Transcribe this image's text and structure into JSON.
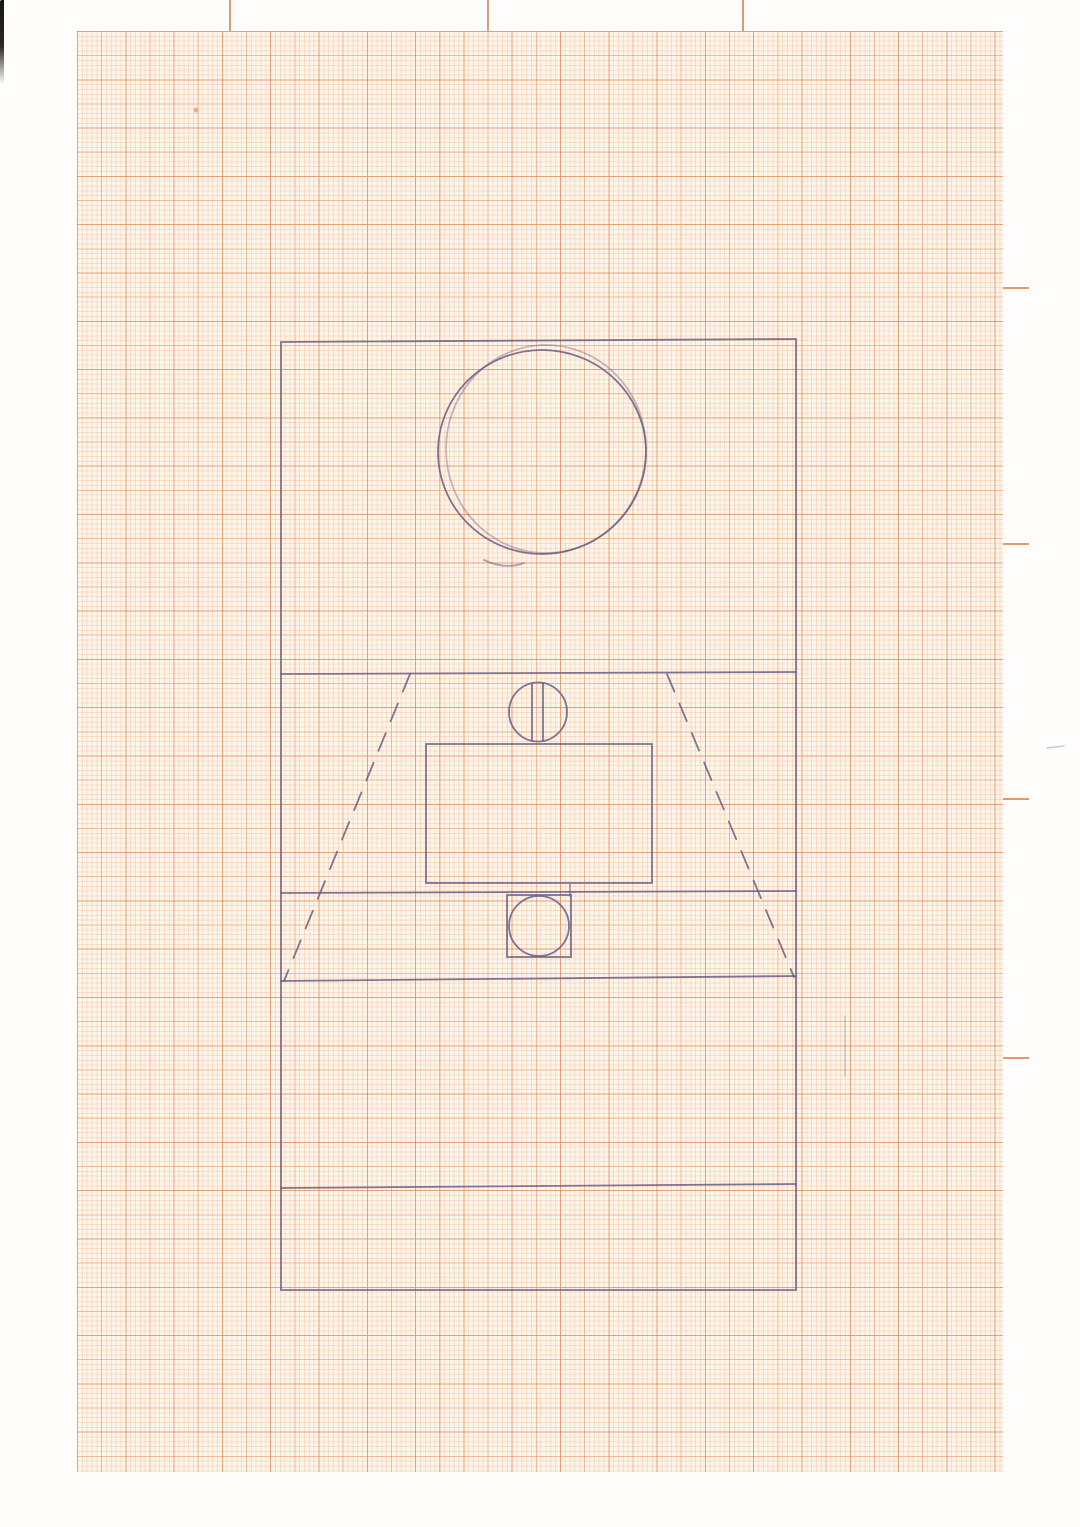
{
  "document": {
    "kind": "scanned hand-drawn sketch on millimeter graph paper",
    "canvas": {
      "width": 1080,
      "height": 1527
    }
  },
  "colors": {
    "paper_bg": "#fdf5e9",
    "grid_minor": "rgba(235,170,125,0.30)",
    "grid_major": "rgba(224,140,92,0.42)",
    "grid_coarse": "rgba(213,123,76,0.40)",
    "tick_color": "#dd9c6f",
    "ink": "#6b5d82",
    "pencil": "#b9c2cc",
    "scan_background": "#fefdfb"
  },
  "paper": {
    "grid_area": {
      "left": 77,
      "top": 31,
      "width": 926,
      "height": 1441
    },
    "minor_spacing_px": 4.83,
    "major_spacing_px": 24.15,
    "top_registration_ticks_x": [
      229,
      487,
      742
    ],
    "right_registration_ticks_y": [
      287,
      543,
      798,
      1057
    ],
    "right_tick_start_x": 1003,
    "right_tick_length": 26
  },
  "sketch": {
    "ink_default": {
      "color": "#6b5d82",
      "width": 1.8,
      "opacity": 0.85
    },
    "shapes": [
      {
        "name": "outer-rectangle",
        "kind": "polygon",
        "points": "281,342 796,339 796,1290 281,1290"
      },
      {
        "name": "large-circle",
        "kind": "ellipse",
        "cx": 542,
        "cy": 452,
        "rx": 104,
        "ry": 102
      },
      {
        "name": "large-circle-overstroke",
        "kind": "ellipse",
        "cx": 546,
        "cy": 449,
        "rx": 100,
        "ry": 104,
        "opacity": 0.4
      },
      {
        "name": "large-circle-tail",
        "kind": "path",
        "d": "M484,560 Q505,570 524,563",
        "opacity": 0.55
      },
      {
        "name": "horizontal-divider-1",
        "kind": "line",
        "x1": 281,
        "y1": 674,
        "x2": 796,
        "y2": 672
      },
      {
        "name": "slotted-circle",
        "kind": "ellipse",
        "cx": 538,
        "cy": 712,
        "rx": 29,
        "ry": 29.5
      },
      {
        "name": "slot-line-left",
        "kind": "line",
        "x1": 532,
        "y1": 684,
        "x2": 532,
        "y2": 740
      },
      {
        "name": "slot-line-right",
        "kind": "line",
        "x1": 543,
        "y1": 683.5,
        "x2": 543,
        "y2": 740.5
      },
      {
        "name": "inner-rectangle",
        "kind": "rect",
        "x": 426,
        "y": 744,
        "w": 226,
        "h": 139
      },
      {
        "name": "horizontal-divider-2",
        "kind": "line",
        "x1": 281,
        "y1": 893,
        "x2": 796,
        "y2": 891
      },
      {
        "name": "small-square",
        "kind": "rect",
        "x": 507,
        "y": 895,
        "w": 64,
        "h": 62
      },
      {
        "name": "small-square-overshoot",
        "kind": "line",
        "x1": 570,
        "y1": 884,
        "x2": 570,
        "y2": 896,
        "opacity": 0.6
      },
      {
        "name": "small-square-circle",
        "kind": "ellipse",
        "cx": 539,
        "cy": 926,
        "rx": 30,
        "ry": 30
      },
      {
        "name": "horizontal-divider-3",
        "kind": "line",
        "x1": 281,
        "y1": 981,
        "x2": 796,
        "y2": 976
      },
      {
        "name": "dashed-diagonal-left",
        "kind": "line",
        "x1": 410,
        "y1": 674,
        "x2": 284,
        "y2": 981,
        "dash": "19 13"
      },
      {
        "name": "dashed-diagonal-right",
        "kind": "line",
        "x1": 667,
        "y1": 674,
        "x2": 794,
        "y2": 977,
        "dash": "19 13"
      },
      {
        "name": "horizontal-divider-4",
        "kind": "line",
        "x1": 281,
        "y1": 1188,
        "x2": 796,
        "y2": 1184
      },
      {
        "name": "stray-ink-mark",
        "kind": "line",
        "x1": 845,
        "y1": 1016,
        "x2": 845,
        "y2": 1076,
        "opacity": 0.35,
        "width": 1.2
      },
      {
        "name": "pencil-dash-right-margin",
        "kind": "line",
        "x1": 1047,
        "y1": 748,
        "x2": 1064,
        "y2": 746,
        "color": "#b9c2cc",
        "opacity": 0.85,
        "width": 1.5
      },
      {
        "name": "paper-speck",
        "kind": "ellipse",
        "cx": 196,
        "cy": 110,
        "rx": 1.6,
        "ry": 1.6,
        "color": "#e0a070",
        "fill": true,
        "opacity": 0.8
      }
    ]
  }
}
